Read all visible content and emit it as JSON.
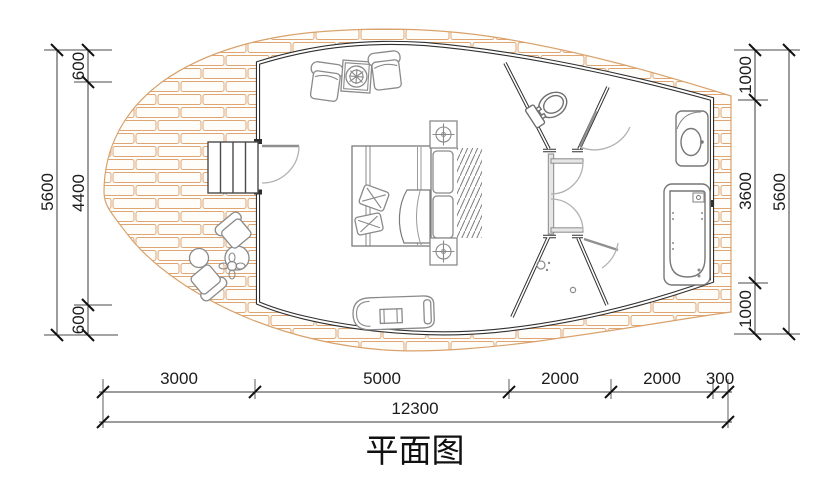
{
  "title": "平面图",
  "dimensions": {
    "left_outer": "5600",
    "left_chain": [
      "600",
      "4400",
      "600"
    ],
    "right_chain": [
      "1000",
      "3600",
      "1000"
    ],
    "right_outer": "5600",
    "bottom_chain": [
      "3000",
      "5000",
      "2000",
      "2000",
      "300"
    ],
    "bottom_total": "12300"
  },
  "colors": {
    "brick_outline": "#dfa673",
    "wall": "#2f2f2f",
    "partition_gray": "#8a8a8a",
    "background": "#ffffff"
  },
  "icons": [
    "wood-deck",
    "entry-steps",
    "entry-door",
    "lounge-chair",
    "plant-table",
    "double-bed",
    "pillows",
    "blanket",
    "nightstand-lamp",
    "bedside-rug",
    "chaise-lounge",
    "outdoor-table",
    "outdoor-stool",
    "outdoor-chair",
    "flower-pot",
    "toilet",
    "wash-basin",
    "bathtub",
    "shower-head",
    "floor-drain"
  ]
}
